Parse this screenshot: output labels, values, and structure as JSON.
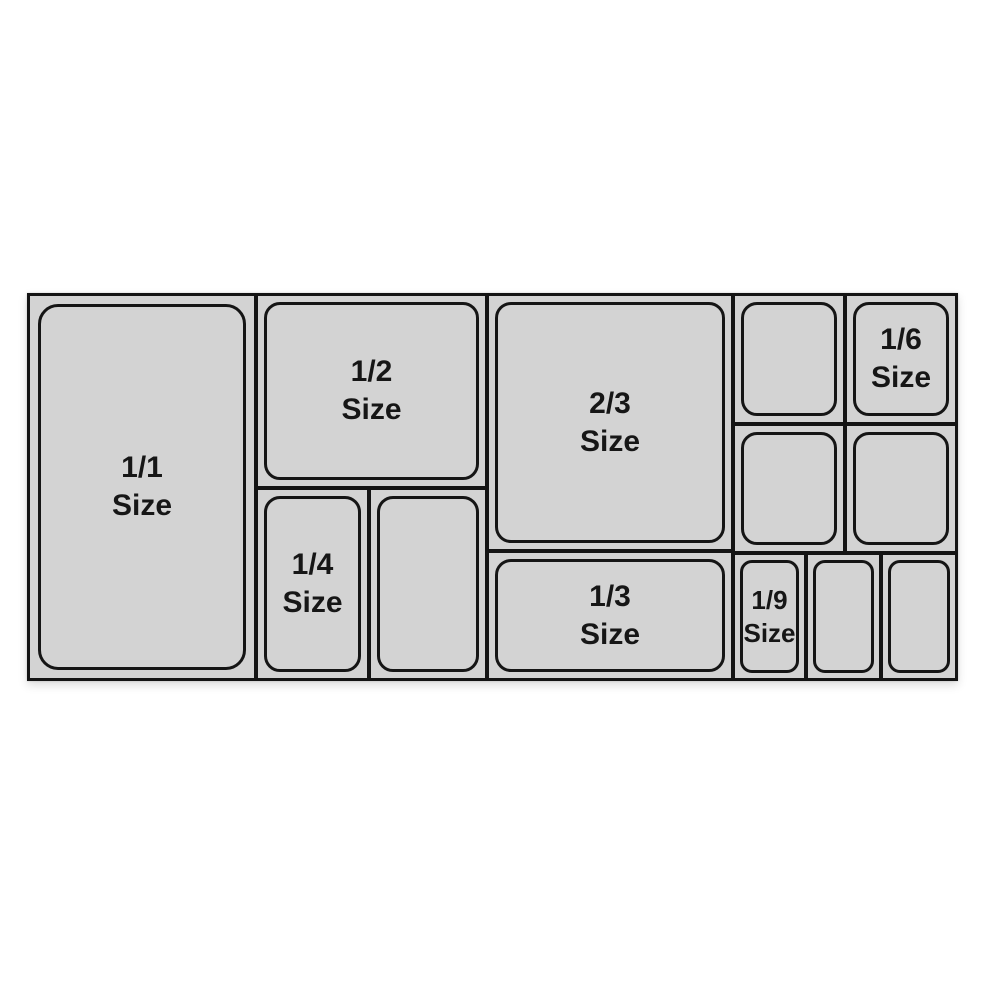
{
  "diagram": {
    "description_label": "gastronorm-pan-size-layout",
    "colors": {
      "background": "#ffffff",
      "pan_fill": "#d3d3d3",
      "border": "#141414",
      "text": "#161616"
    },
    "pans": [
      {
        "id": "1-1",
        "labeled": true,
        "label_line1": "1/1",
        "label_line2": "Size"
      },
      {
        "id": "1-2",
        "labeled": true,
        "label_line1": "1/2",
        "label_line2": "Size"
      },
      {
        "id": "1-4",
        "labeled": true,
        "label_line1": "1/4",
        "label_line2": "Size"
      },
      {
        "id": "1-4-unlabeled",
        "labeled": false
      },
      {
        "id": "2-3",
        "labeled": true,
        "label_line1": "2/3",
        "label_line2": "Size"
      },
      {
        "id": "1-3",
        "labeled": true,
        "label_line1": "1/3",
        "label_line2": "Size"
      },
      {
        "id": "1-6-unlabeled-a",
        "labeled": false
      },
      {
        "id": "1-6",
        "labeled": true,
        "label_line1": "1/6",
        "label_line2": "Size"
      },
      {
        "id": "1-6-unlabeled-b",
        "labeled": false
      },
      {
        "id": "1-6-unlabeled-c",
        "labeled": false
      },
      {
        "id": "1-9",
        "labeled": true,
        "label_line1": "1/9",
        "label_line2": "Size"
      },
      {
        "id": "1-9-unlabeled-a",
        "labeled": false
      },
      {
        "id": "1-9-unlabeled-b",
        "labeled": false
      }
    ]
  }
}
